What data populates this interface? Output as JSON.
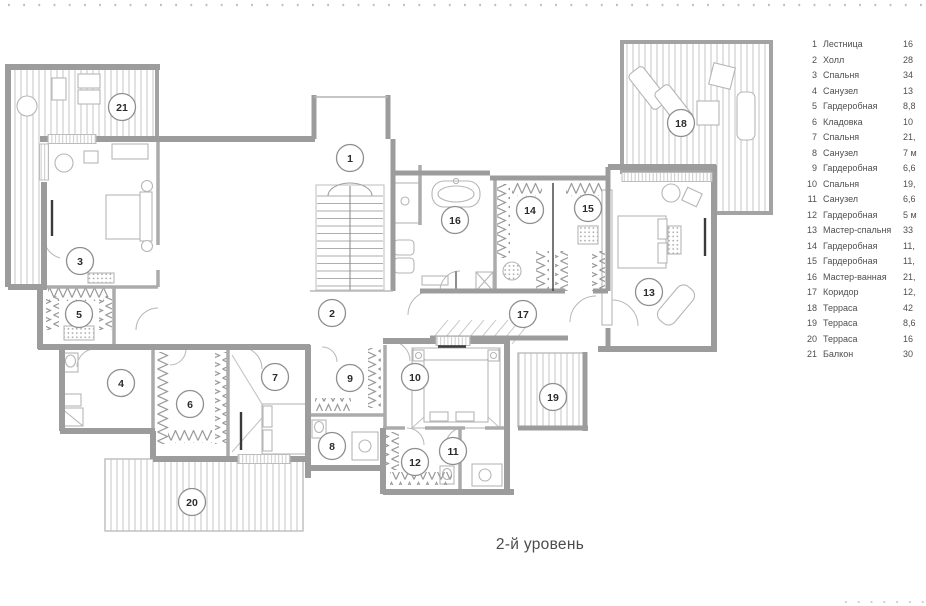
{
  "title": {
    "caption": "2-й уровень"
  },
  "plan": {
    "room_numbers": [
      "1",
      "2",
      "3",
      "4",
      "5",
      "6",
      "7",
      "8",
      "9",
      "10",
      "11",
      "12",
      "13",
      "14",
      "15",
      "16",
      "17",
      "18",
      "19",
      "20",
      "21"
    ]
  },
  "legend": {
    "items": [
      {
        "num": "1",
        "name": "Лестница",
        "area": "16"
      },
      {
        "num": "2",
        "name": "Холл",
        "area": "28"
      },
      {
        "num": "3",
        "name": "Спальня",
        "area": "34"
      },
      {
        "num": "4",
        "name": "Санузел",
        "area": "13"
      },
      {
        "num": "5",
        "name": "Гардеробная",
        "area": "8,8"
      },
      {
        "num": "6",
        "name": "Кладовка",
        "area": "10"
      },
      {
        "num": "7",
        "name": "Спальня",
        "area": "21,"
      },
      {
        "num": "8",
        "name": "Санузел",
        "area": "7 м"
      },
      {
        "num": "9",
        "name": "Гардеробная",
        "area": "6,6"
      },
      {
        "num": "10",
        "name": "Спальня",
        "area": "19,"
      },
      {
        "num": "11",
        "name": "Санузел",
        "area": "6,6"
      },
      {
        "num": "12",
        "name": "Гардеробная",
        "area": "5 м"
      },
      {
        "num": "13",
        "name": "Мастер-спальня",
        "area": "33"
      },
      {
        "num": "14",
        "name": "Гардеробная",
        "area": "11,"
      },
      {
        "num": "15",
        "name": "Гардеробная",
        "area": "11,"
      },
      {
        "num": "16",
        "name": "Мастер-ванная",
        "area": "21,"
      },
      {
        "num": "17",
        "name": "Коридор",
        "area": "12,"
      },
      {
        "num": "18",
        "name": "Терраса",
        "area": "42"
      },
      {
        "num": "19",
        "name": "Терраса",
        "area": "8,6"
      },
      {
        "num": "20",
        "name": "Терраса",
        "area": "16"
      },
      {
        "num": "21",
        "name": "Балкон",
        "area": "30"
      }
    ]
  }
}
